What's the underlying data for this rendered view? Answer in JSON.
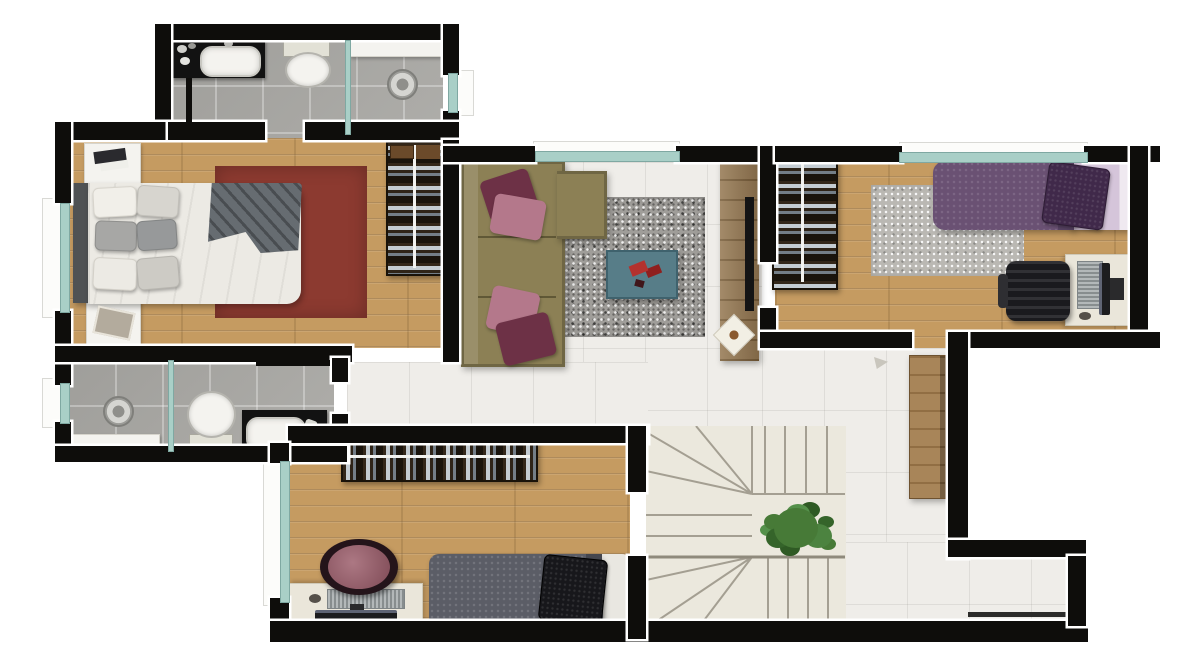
{
  "scene": {
    "kind": "apartment-floor-plan-render",
    "view": "top-down",
    "rooms": [
      {
        "name": "bathroom-top",
        "floor": "gray-tile",
        "fixtures": [
          "vanity-sink",
          "toilet",
          "shower-with-glass-partition",
          "floor-drain"
        ]
      },
      {
        "name": "master-bedroom",
        "floor": "wood",
        "furniture": [
          "double-bed",
          "two-nightstands",
          "maroon-rug",
          "open-wardrobe"
        ]
      },
      {
        "name": "bathroom-lower",
        "floor": "gray-tile",
        "fixtures": [
          "shower-with-glass-partition",
          "floor-drain",
          "toilet",
          "vanity-sink",
          "bench"
        ]
      },
      {
        "name": "bedroom-bottom",
        "floor": "wood",
        "furniture": [
          "open-wardrobe",
          "single-bed-gray",
          "desk-with-monitor",
          "round-maroon-chair"
        ]
      },
      {
        "name": "living-room",
        "floor": "white-tile",
        "furniture": [
          "l-shaped-olive-sofa",
          "speckled-gray-rug",
          "teal-coffee-table",
          "tv-console"
        ]
      },
      {
        "name": "bedroom-right",
        "floor": "wood",
        "furniture": [
          "open-wardrobe",
          "light-gray-rug",
          "single-bed-purple",
          "desk-with-monitor",
          "black-office-chair"
        ]
      },
      {
        "name": "hallway",
        "floor": "white-tile"
      },
      {
        "name": "staircase",
        "type": "u-shaped-with-winders",
        "feature": "green-plant"
      },
      {
        "name": "entry",
        "feature": "open-wood-door"
      },
      {
        "name": "light-well-void",
        "floor": "none"
      }
    ]
  },
  "colors": {
    "wall": "#0e0d0b",
    "glass": "#a9cfc7",
    "wood_floor": "#c59b61",
    "closet_brown": "#33271a",
    "rug_maroon": "#8c3a30",
    "rug_gray": "#9f9d99",
    "rug_light": "#bab8b3",
    "sofa_olive": "#8c8055",
    "pillow_maroon": "#6d3146",
    "pillow_pink": "#b4788b",
    "table_teal": "#577d88",
    "decor_red": "#b3322e",
    "bed_white": "#eceae4",
    "blanket_gray": "#5d6368",
    "headboard": "#4f5254",
    "duvet_purple": "#6a5173",
    "pillow_purple": "#40294a",
    "sheet_lavender": "#d5c5da",
    "duvet_gray": "#5b5d66",
    "pillow_black": "#17171b",
    "desk_cream": "#eae6da",
    "keyboard_gray": "#9aa0a2",
    "chair_maroon": "#9a5a68",
    "chair_black": "#28282c",
    "door_wood": "#a17b4b",
    "console_wood": "#8a6a40",
    "plant_green": "#477a37",
    "tile_gray": "#a9a8a4",
    "tile_white": "#efede9",
    "stair_floor": "#ebe8dd",
    "counter_black": "#121212",
    "porcelain": "#f4f3ef"
  }
}
